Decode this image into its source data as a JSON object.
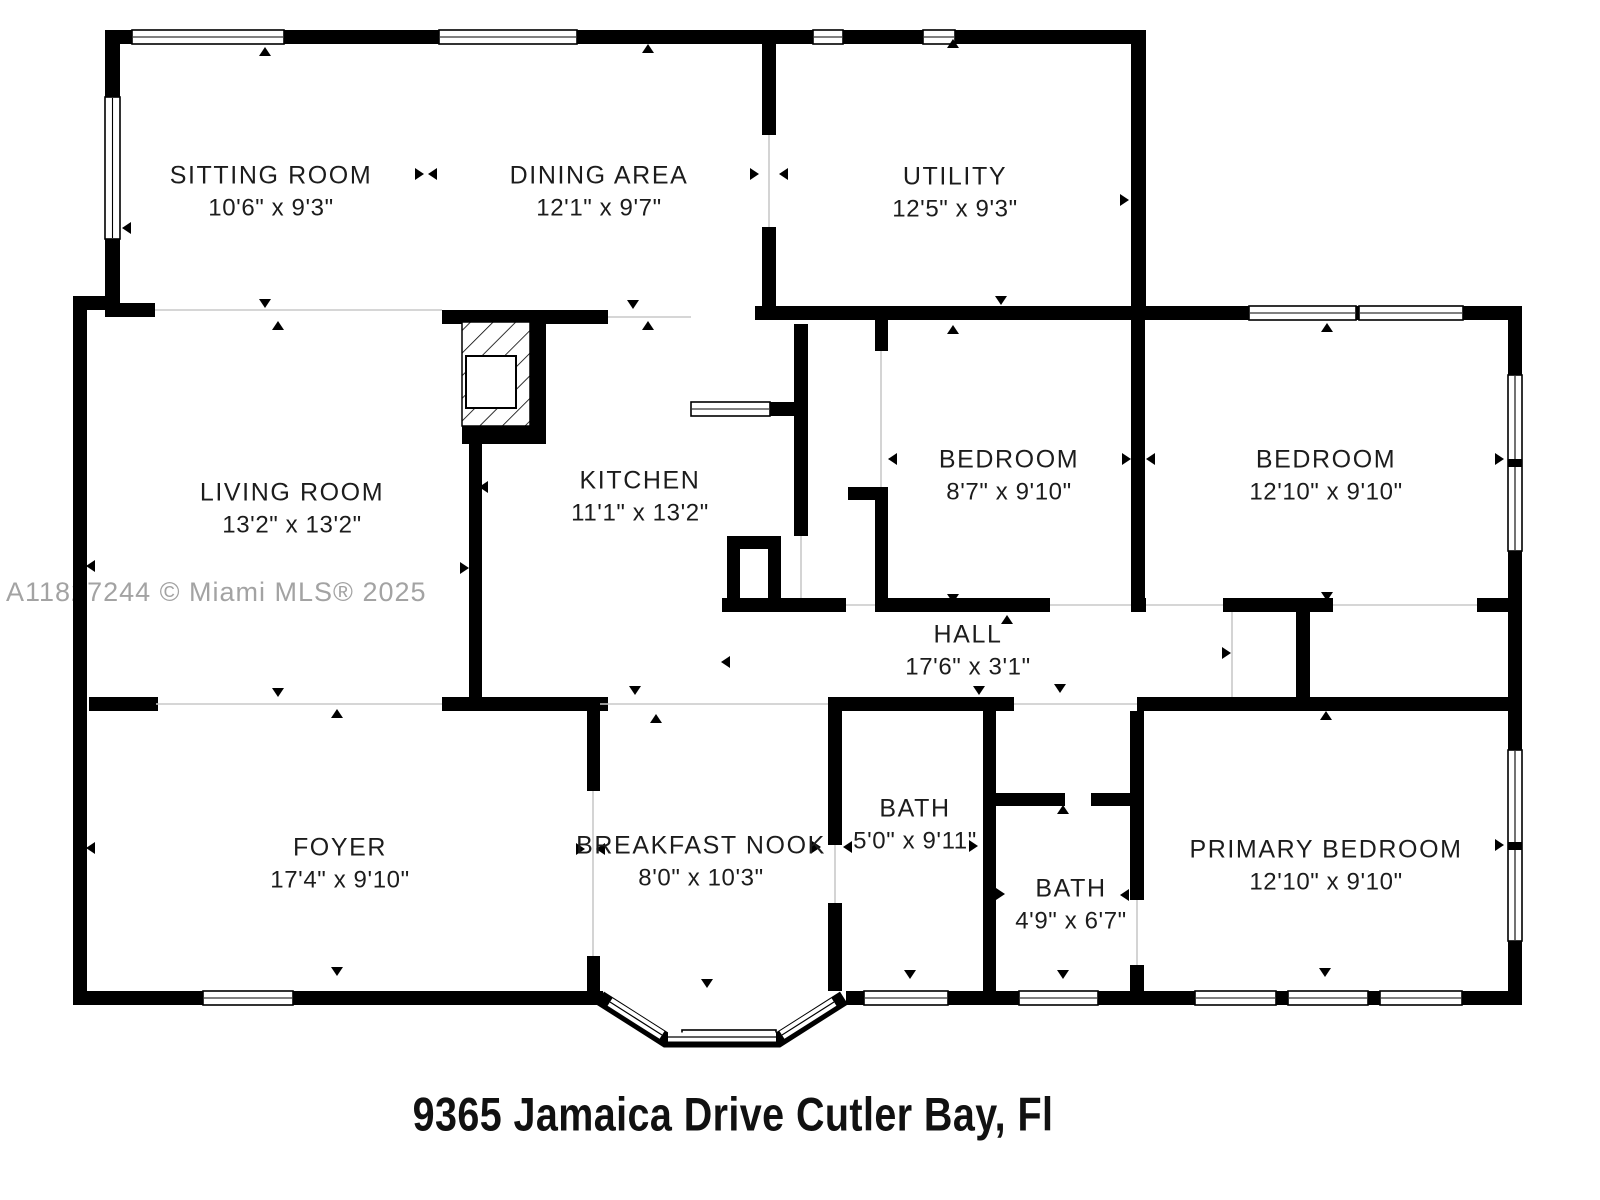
{
  "page": {
    "background": "#ffffff",
    "wall_color": "#000000",
    "opening_line_color": "#c9c9c9",
    "watermark_color": "#a3a3a3"
  },
  "watermark": {
    "text": "A11827244 © Miami MLS® 2025"
  },
  "caption": {
    "text": "9365 Jamaica Drive Cutler Bay, Fl"
  },
  "rooms": [
    {
      "id": "sitting-room",
      "name": "SITTING ROOM",
      "dims": "10'6\" x 9'3\""
    },
    {
      "id": "dining-area",
      "name": "DINING AREA",
      "dims": "12'1\" x 9'7\""
    },
    {
      "id": "utility",
      "name": "UTILITY",
      "dims": "12'5\" x 9'3\""
    },
    {
      "id": "living-room",
      "name": "LIVING ROOM",
      "dims": "13'2\" x 13'2\""
    },
    {
      "id": "kitchen",
      "name": "KITCHEN",
      "dims": "11'1\" x 13'2\""
    },
    {
      "id": "bedroom-1",
      "name": "BEDROOM",
      "dims": "8'7\" x 9'10\""
    },
    {
      "id": "bedroom-2",
      "name": "BEDROOM",
      "dims": "12'10\" x 9'10\""
    },
    {
      "id": "hall",
      "name": "HALL",
      "dims": "17'6\" x 3'1\""
    },
    {
      "id": "foyer",
      "name": "FOYER",
      "dims": "17'4\" x 9'10\""
    },
    {
      "id": "breakfast-nook",
      "name": "BREAKFAST NOOK",
      "dims": "8'0\" x 10'3\""
    },
    {
      "id": "bath-1",
      "name": "BATH",
      "dims": "5'0\" x 9'11\""
    },
    {
      "id": "bath-2",
      "name": "BATH",
      "dims": "4'9\" x 6'7\""
    },
    {
      "id": "primary-bedroom",
      "name": "PRIMARY BEDROOM",
      "dims": "12'10\" x 9'10\""
    }
  ]
}
